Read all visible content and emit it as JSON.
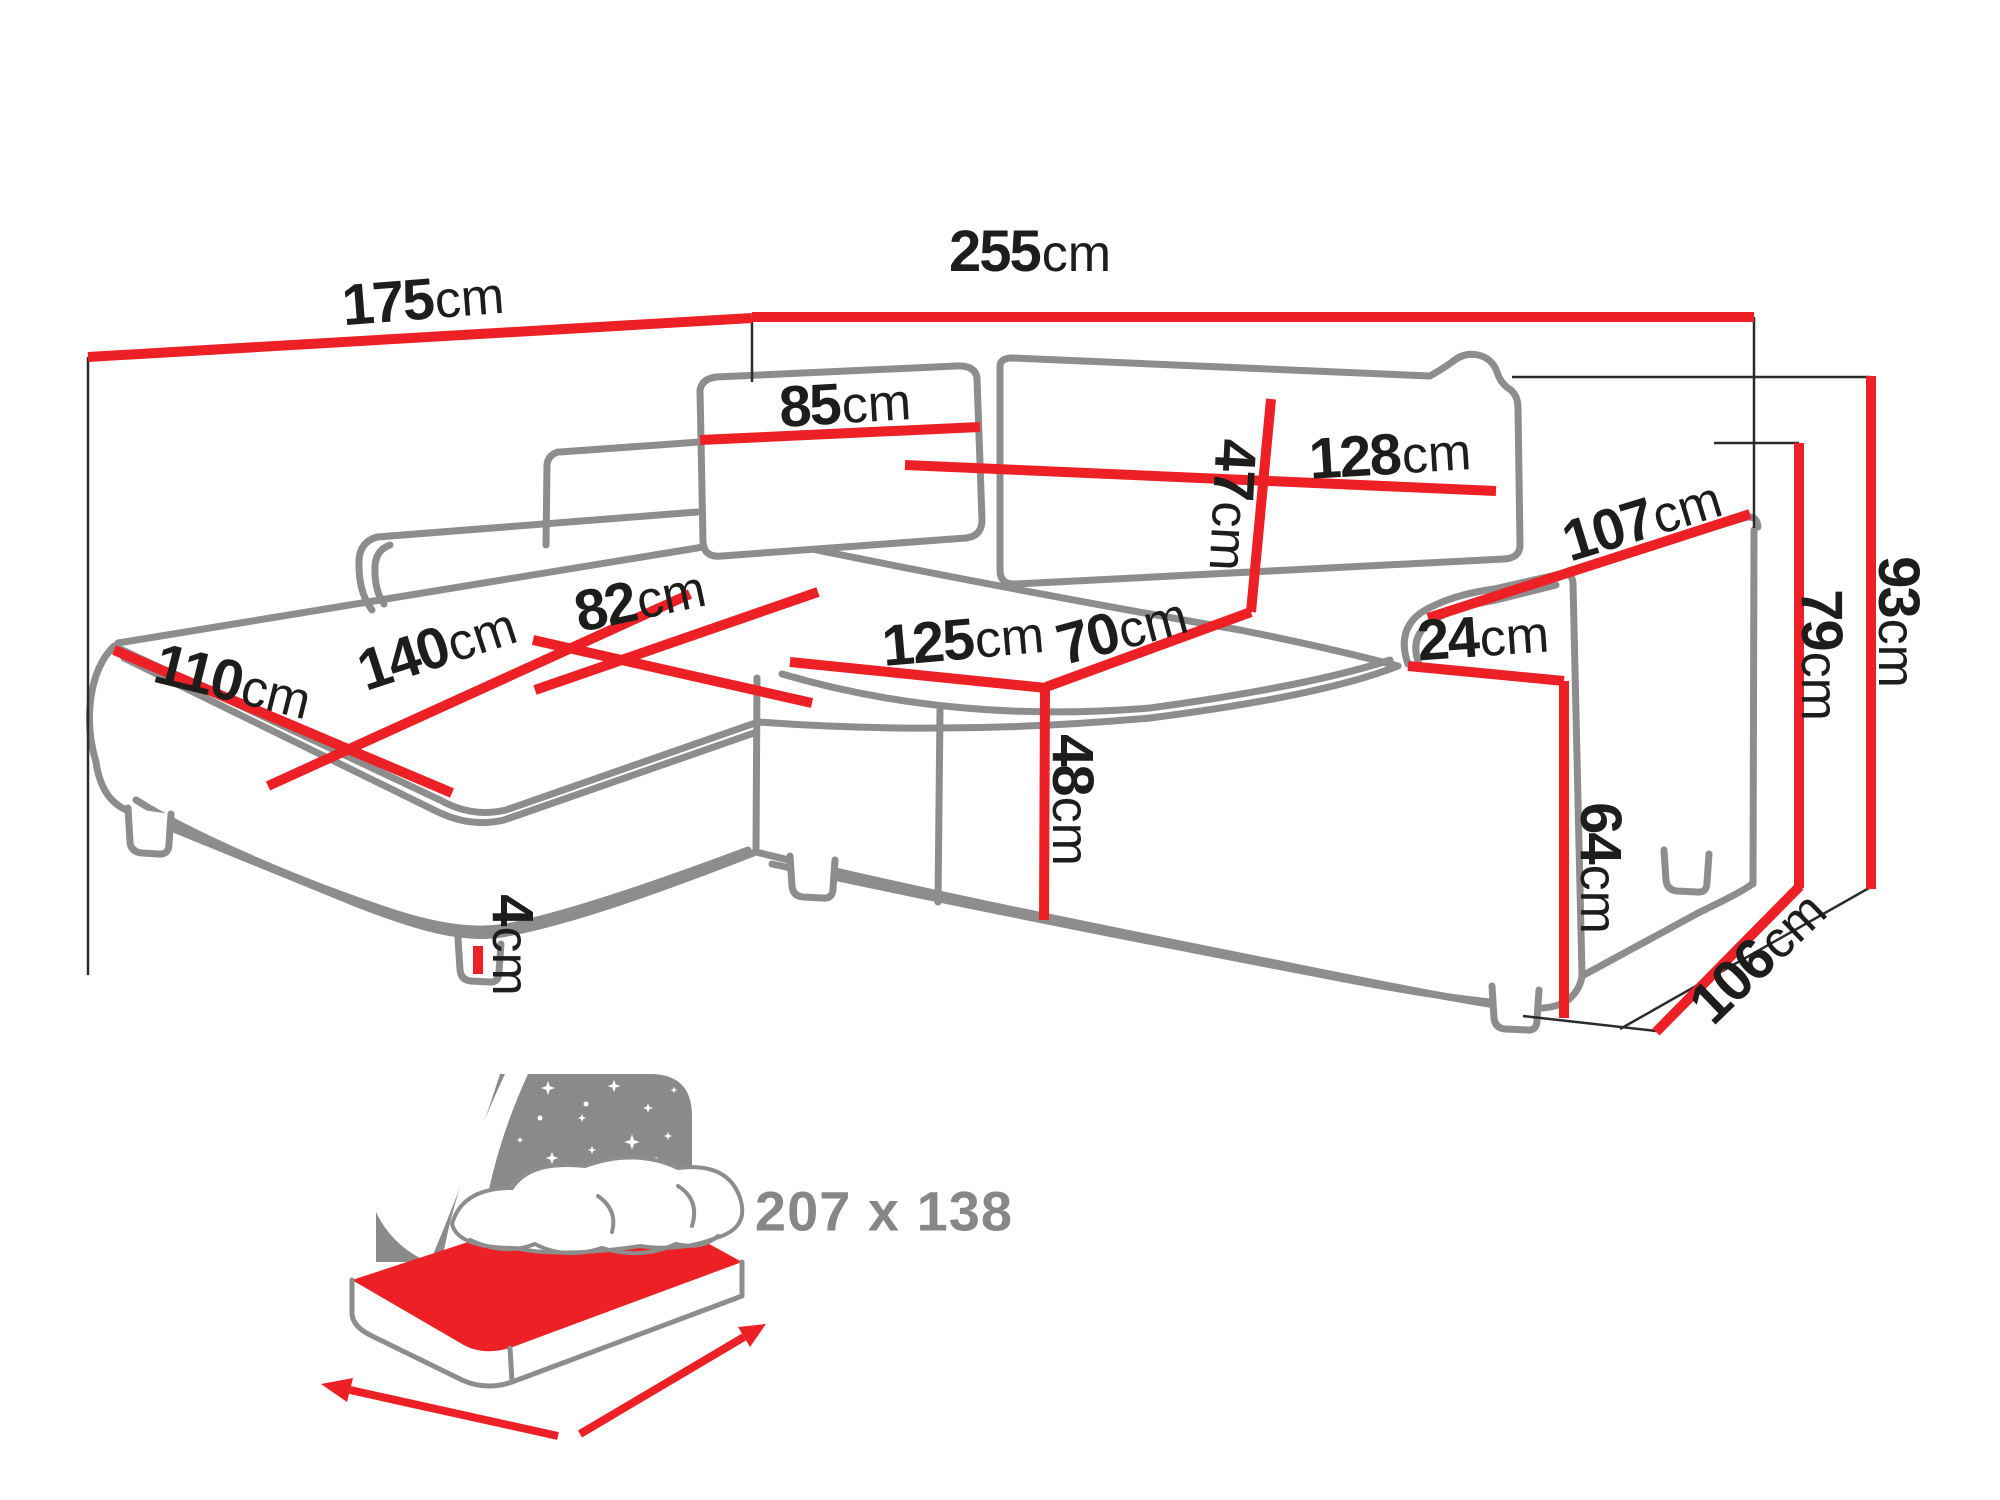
{
  "page": {
    "type": "furniture dimension diagram",
    "product": "corner sofa bed"
  },
  "dimensions": {
    "d175": {
      "value": "175",
      "unit": "cm"
    },
    "d255": {
      "value": "255",
      "unit": "cm"
    },
    "d85": {
      "value": "85",
      "unit": "cm"
    },
    "d128": {
      "value": "128",
      "unit": "cm"
    },
    "d47": {
      "value": "47",
      "unit": "cm"
    },
    "d107": {
      "value": "107",
      "unit": "cm"
    },
    "d110": {
      "value": "110",
      "unit": "cm"
    },
    "d140": {
      "value": "140",
      "unit": "cm"
    },
    "d82": {
      "value": "82",
      "unit": "cm"
    },
    "d125": {
      "value": "125",
      "unit": "cm"
    },
    "d70": {
      "value": "70",
      "unit": "cm"
    },
    "d24": {
      "value": "24",
      "unit": "cm"
    },
    "d48": {
      "value": "48",
      "unit": "cm"
    },
    "d64": {
      "value": "64",
      "unit": "cm"
    },
    "d4": {
      "value": "4",
      "unit": "cm"
    },
    "d79": {
      "value": "79",
      "unit": "cm"
    },
    "d93": {
      "value": "93",
      "unit": "cm"
    },
    "d106": {
      "value": "106",
      "unit": "cm"
    }
  },
  "sleeping_area": {
    "label": "207 x 138"
  },
  "colors": {
    "dimension_red": "#ec2025",
    "sofa_outline_grey": "#8d8d8d",
    "label_black": "#1d1d1b",
    "icon_grey": "#8a8a8a"
  },
  "icons": [
    {
      "name": "sofa-bed-sleeping-function-icon"
    }
  ]
}
